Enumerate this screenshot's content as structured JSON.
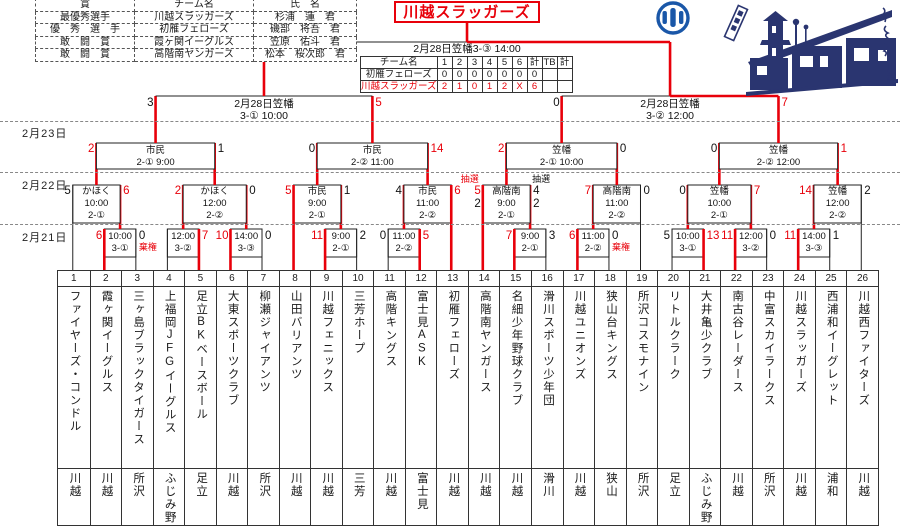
{
  "champion": {
    "name": "川越スラッガーズ"
  },
  "final_label": "2月28日笠幡3-③ 14:00",
  "dates": [
    "2月23日",
    "2月22日",
    "2月21日"
  ],
  "awards": {
    "headers": [
      "賞",
      "チーム名",
      "氏　名"
    ],
    "rows": [
      [
        "最優秀選手",
        "川越スラッガーズ",
        "杉浦　蓮　君"
      ],
      [
        "優　秀　選　手",
        "初雁フェローズ",
        "磯部　将吾　君"
      ],
      [
        "敢　闘　賞",
        "霞ヶ関イーグルス",
        "笠原　佑斗　君"
      ],
      [
        "敢　闘　賞",
        "高階南ヤンガース",
        "松本　桜次郎　君"
      ]
    ]
  },
  "final_table": {
    "headers": [
      "チーム名",
      "1",
      "2",
      "3",
      "4",
      "5",
      "6",
      "計",
      "TB",
      "計"
    ],
    "rows": [
      {
        "name": "初雁フェローズ",
        "cells": [
          "0",
          "0",
          "0",
          "0",
          "0",
          "0",
          "0",
          "",
          ""
        ],
        "red": false
      },
      {
        "name": "川越スラッガーズ",
        "cells": [
          "2",
          "1",
          "0",
          "1",
          "2",
          "X",
          "6",
          "",
          ""
        ],
        "red": true
      }
    ]
  },
  "artwork": {
    "caption": "川越",
    "emblem_color": "#1a57a8",
    "art_color": "#2a3570"
  },
  "colors": {
    "win": "#e8000a",
    "line": "#222222"
  },
  "teams": [
    {
      "no": "1",
      "name": "ファイヤーズ・コンドル",
      "city": "川越"
    },
    {
      "no": "2",
      "name": "霞ヶ関イーグルス",
      "city": "川越"
    },
    {
      "no": "3",
      "name": "三ヶ島ブラックタイガース",
      "city": "所沢"
    },
    {
      "no": "4",
      "name": "上福岡JFGイーグルス",
      "city": "ふじみ野"
    },
    {
      "no": "5",
      "name": "足立BKベースボール",
      "city": "足立"
    },
    {
      "no": "6",
      "name": "大東スポーツクラブ",
      "city": "川越"
    },
    {
      "no": "7",
      "name": "柳瀬ジャイアンツ",
      "city": "所沢"
    },
    {
      "no": "8",
      "name": "山田バリアンツ",
      "city": "川越"
    },
    {
      "no": "9",
      "name": "川越フェニックス",
      "city": "川越"
    },
    {
      "no": "10",
      "name": "三芳ホープ",
      "city": "三芳"
    },
    {
      "no": "11",
      "name": "高階キングス",
      "city": "川越"
    },
    {
      "no": "12",
      "name": "富士見ASK",
      "city": "富士見"
    },
    {
      "no": "13",
      "name": "初雁フェローズ",
      "city": "川越"
    },
    {
      "no": "14",
      "name": "高階南ヤンガース",
      "city": "川越"
    },
    {
      "no": "15",
      "name": "名細少年野球クラブ",
      "city": "川越"
    },
    {
      "no": "16",
      "name": "滑川スポーツ少年団",
      "city": "滑川"
    },
    {
      "no": "17",
      "name": "川越ユニオンズ",
      "city": "川越"
    },
    {
      "no": "18",
      "name": "狭山台キングス",
      "city": "狭山"
    },
    {
      "no": "19",
      "name": "所沢コスモナイン",
      "city": "所沢"
    },
    {
      "no": "20",
      "name": "リトルクラーク",
      "city": "足立"
    },
    {
      "no": "21",
      "name": "大井亀少クラブ",
      "city": "ふじみ野"
    },
    {
      "no": "22",
      "name": "南古谷レーダース",
      "city": "川越"
    },
    {
      "no": "23",
      "name": "中富スカイラークス",
      "city": "所沢"
    },
    {
      "no": "24",
      "name": "川越スラッガーズ",
      "city": "川越"
    },
    {
      "no": "25",
      "name": "西浦和イーグレット",
      "city": "浦和"
    },
    {
      "no": "26",
      "name": "川越西ファイターズ",
      "city": "川越"
    }
  ],
  "bracket": {
    "first_round": [
      {
        "pair": [
          2,
          3
        ],
        "time": "10:00",
        "game": "3-①",
        "score_left": "6",
        "score_right": "0",
        "winner": "left",
        "note_right": "棄権"
      },
      {
        "pair": [
          4,
          5
        ],
        "time": "12:00",
        "game": "3-②",
        "score_left": "",
        "score_right": "7",
        "winner": "right"
      },
      {
        "pair": [
          6,
          7
        ],
        "time": "14:00",
        "game": "3-③",
        "score_left": "10",
        "score_right": "0",
        "winner": "left"
      },
      {
        "pair": [
          9,
          10
        ],
        "time": "9:00",
        "game": "2-①",
        "score_left": "11",
        "score_right": "2",
        "winner": "left"
      },
      {
        "pair": [
          11,
          12
        ],
        "time": "11:00",
        "game": "2-②",
        "score_left": "0",
        "score_right": "5",
        "winner": "right"
      },
      {
        "pair": [
          15,
          16
        ],
        "time": "9:00",
        "game": "2-①",
        "score_left": "7",
        "score_right": "3",
        "winner": "left"
      },
      {
        "pair": [
          17,
          18
        ],
        "time": "11:00",
        "game": "2-②",
        "score_left": "6",
        "score_right": "0",
        "winner": "left",
        "note_right": "棄権"
      },
      {
        "pair": [
          20,
          21
        ],
        "time": "10:00",
        "game": "3-①",
        "score_left": "5",
        "score_right": "13",
        "winner": "right"
      },
      {
        "pair": [
          22,
          23
        ],
        "time": "12:00",
        "game": "3-②",
        "score_left": "11",
        "score_right": "0",
        "winner": "left"
      },
      {
        "pair": [
          24,
          25
        ],
        "time": "14:00",
        "game": "3-③",
        "score_left": "11",
        "score_right": "1",
        "winner": "left"
      }
    ],
    "round2": [
      {
        "left": "bye:1",
        "right": "fr:0",
        "venue": "かほく",
        "time": "10:00",
        "game": "2-①",
        "score_left": "5",
        "score_right": "6",
        "winner": "right"
      },
      {
        "left": "fr:1",
        "right": "fr:2",
        "venue": "かほく",
        "time": "12:00",
        "game": "2-②",
        "score_left": "2",
        "score_right": "0",
        "winner": "left"
      },
      {
        "left": "bye:8",
        "right": "fr:3",
        "venue": "市民",
        "time": "9:00",
        "game": "2-①",
        "score_left": "5",
        "score_right": "1",
        "winner": "left"
      },
      {
        "left": "fr:4",
        "right": "bye:13",
        "venue": "市民",
        "time": "11:00",
        "game": "2-②",
        "score_left": "4",
        "score_right": "6",
        "winner": "right"
      },
      {
        "left": "bye:14",
        "right": "fr:5",
        "venue": "高階南",
        "time": "9:00",
        "game": "2-①",
        "score_left": "5",
        "score_right": "4",
        "score_left2": "2",
        "score_right2": "2",
        "note_left": "抽選",
        "note_right": "抽選",
        "winner": "left"
      },
      {
        "left": "fr:6",
        "right": "bye:19",
        "venue": "高階南",
        "time": "11:00",
        "game": "2-②",
        "score_left": "7",
        "score_right": "0",
        "winner": "left"
      },
      {
        "left": "fr:7",
        "right": "fr:8",
        "venue": "笠幡",
        "time": "10:00",
        "game": "2-①",
        "score_left": "0",
        "score_right": "7",
        "winner": "right"
      },
      {
        "left": "fr:9",
        "right": "bye:26",
        "venue": "笠幡",
        "time": "12:00",
        "game": "2-②",
        "score_left": "14",
        "score_right": "2",
        "winner": "left"
      }
    ],
    "quarterfinals": [
      {
        "venue": "市民",
        "game_time": "2-① 9:00",
        "score_left": "2",
        "score_right": "1",
        "winner": "left"
      },
      {
        "venue": "市民",
        "game_time": "2-② 11:00",
        "score_left": "0",
        "score_right": "14",
        "winner": "right"
      },
      {
        "venue": "笠幡",
        "game_time": "2-① 10:00",
        "score_left": "2",
        "score_right": "0",
        "winner": "left"
      },
      {
        "venue": "笠幡",
        "game_time": "2-② 12:00",
        "score_left": "0",
        "score_right": "1",
        "winner": "right"
      }
    ],
    "semifinals": [
      {
        "label1": "2月28日笠幡",
        "label2": "3-① 10:00",
        "score_left": "3",
        "score_right": "5",
        "winner": "right"
      },
      {
        "label1": "2月28日笠幡",
        "label2": "3-② 12:00",
        "score_left": "0",
        "score_right": "7",
        "winner": "right"
      }
    ]
  }
}
